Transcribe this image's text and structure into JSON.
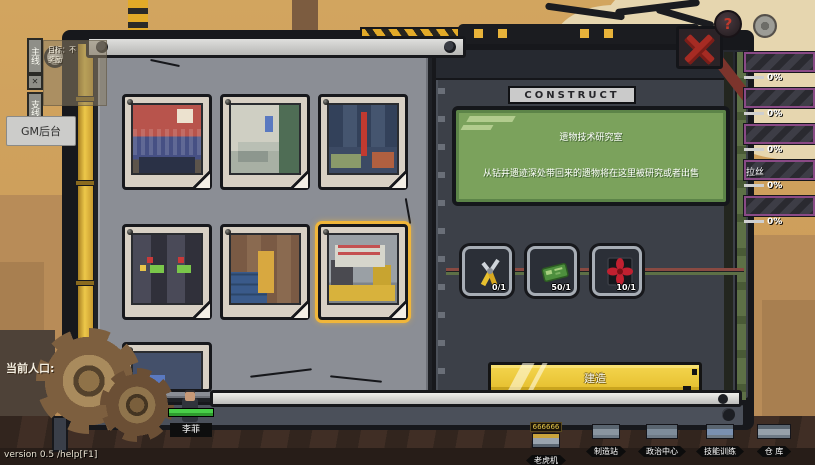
{
  "colors": {
    "accent_yellow": "#e9c531",
    "panel_gray": "#8b8e95",
    "panel_dark": "#3c4048",
    "info_green": "#7ba25c",
    "close_red": "#a62b23",
    "sky": "#cd9e5b"
  },
  "top": {
    "quest_tab_main": "主线",
    "quest_tab_side": "支线",
    "tab_x": "✕",
    "quest_line1": "目标：不",
    "quest_line2": "奖励",
    "gm_button": "GM后台",
    "help_icon": "?"
  },
  "construct": {
    "header": "CONSTRUCT",
    "building_name": "遗物技术研究室",
    "building_desc": "从钻井遗迹深处带回来的遗物将在这里被研究或者出售",
    "costs": [
      {
        "icon": "pliers-icon",
        "amount": "0/1"
      },
      {
        "icon": "circuit-board-icon",
        "amount": "50/1"
      },
      {
        "icon": "fan-icon",
        "amount": "10/1"
      }
    ],
    "build_button": "建造",
    "thumbnails": [
      {
        "scene": "red-factory-room",
        "selected": false
      },
      {
        "scene": "gray-green-workshop",
        "selected": false
      },
      {
        "scene": "blue-shelf-storeroom",
        "selected": false
      },
      {
        "scene": "slot-machine-hall",
        "selected": false
      },
      {
        "scene": "crate-warehouse",
        "selected": false
      },
      {
        "scene": "relic-research-lab",
        "selected": true
      }
    ]
  },
  "side_bars": [
    {
      "label": "",
      "percent": "0%"
    },
    {
      "label": "",
      "percent": "0%"
    },
    {
      "label": "",
      "percent": "0%"
    },
    {
      "label": "拉丝",
      "percent": "0%"
    },
    {
      "label": "",
      "percent": "0%"
    }
  ],
  "hud_bottom": {
    "population_label": "当前人口:",
    "character_name": "李菲",
    "version_text": "version 0.5 /help[F1]",
    "buildings": [
      {
        "label": "老虎机",
        "badge": "666666"
      },
      {
        "label": "制造站",
        "badge": ""
      },
      {
        "label": "政治中心",
        "badge": ""
      },
      {
        "label": "技能训练",
        "badge": ""
      },
      {
        "label": "仓 库",
        "badge": ""
      }
    ]
  }
}
